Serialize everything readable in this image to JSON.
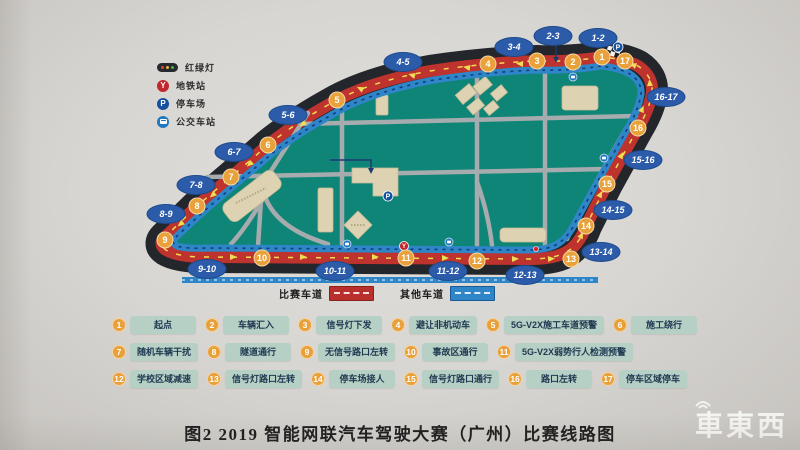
{
  "map_legend": {
    "items": [
      {
        "icon": "traffic-light-icon",
        "label": "红绿灯"
      },
      {
        "icon": "metro-icon",
        "label": "地铁站"
      },
      {
        "icon": "parking-icon",
        "label": "停车场"
      },
      {
        "icon": "bus-icon",
        "label": "公交车站"
      }
    ]
  },
  "lane_legend": {
    "race": {
      "label": "比赛车道",
      "color": "#b92f2b"
    },
    "other": {
      "label": "其他车道",
      "color": "#2e86c8"
    }
  },
  "route": {
    "waypoints": [
      {
        "n": "1",
        "x": 602,
        "y": 57
      },
      {
        "n": "2",
        "x": 573,
        "y": 62
      },
      {
        "n": "3",
        "x": 537,
        "y": 61
      },
      {
        "n": "4",
        "x": 488,
        "y": 64
      },
      {
        "n": "5",
        "x": 337,
        "y": 100
      },
      {
        "n": "6",
        "x": 268,
        "y": 145
      },
      {
        "n": "7",
        "x": 231,
        "y": 177
      },
      {
        "n": "8",
        "x": 197,
        "y": 206
      },
      {
        "n": "9",
        "x": 165,
        "y": 240
      },
      {
        "n": "10",
        "x": 262,
        "y": 258
      },
      {
        "n": "11",
        "x": 406,
        "y": 258
      },
      {
        "n": "12",
        "x": 477,
        "y": 261
      },
      {
        "n": "13",
        "x": 571,
        "y": 259
      },
      {
        "n": "14",
        "x": 586,
        "y": 226
      },
      {
        "n": "15",
        "x": 607,
        "y": 184
      },
      {
        "n": "16",
        "x": 638,
        "y": 128
      },
      {
        "n": "17",
        "x": 625,
        "y": 61
      }
    ],
    "segments": [
      {
        "label": "1-2",
        "x": 598,
        "y": 38
      },
      {
        "label": "2-3",
        "x": 553,
        "y": 36
      },
      {
        "label": "3-4",
        "x": 514,
        "y": 47
      },
      {
        "label": "4-5",
        "x": 403,
        "y": 62
      },
      {
        "label": "5-6",
        "x": 288,
        "y": 115
      },
      {
        "label": "6-7",
        "x": 234,
        "y": 152
      },
      {
        "label": "7-8",
        "x": 196,
        "y": 185
      },
      {
        "label": "8-9",
        "x": 166,
        "y": 214
      },
      {
        "label": "9-10",
        "x": 207,
        "y": 269
      },
      {
        "label": "10-11",
        "x": 335,
        "y": 271
      },
      {
        "label": "11-12",
        "x": 448,
        "y": 271
      },
      {
        "label": "12-13",
        "x": 525,
        "y": 275
      },
      {
        "label": "13-14",
        "x": 601,
        "y": 252
      },
      {
        "label": "14-15",
        "x": 613,
        "y": 210
      },
      {
        "label": "15-16",
        "x": 643,
        "y": 160
      },
      {
        "label": "16-17",
        "x": 666,
        "y": 97
      }
    ],
    "icons": [
      {
        "type": "parking",
        "x": 618,
        "y": 47
      },
      {
        "type": "parking",
        "x": 388,
        "y": 196
      },
      {
        "type": "metro",
        "x": 404,
        "y": 246
      },
      {
        "type": "bus",
        "x": 573,
        "y": 77
      },
      {
        "type": "bus",
        "x": 449,
        "y": 242
      },
      {
        "type": "bus",
        "x": 347,
        "y": 244
      },
      {
        "type": "bus",
        "x": 604,
        "y": 158
      },
      {
        "type": "light",
        "x": 536,
        "y": 249
      }
    ]
  },
  "checkpoints": {
    "rows": [
      [
        {
          "num": "1",
          "label": "起点"
        },
        {
          "num": "2",
          "label": "车辆汇入"
        },
        {
          "num": "3",
          "label": "信号灯下发"
        },
        {
          "num": "4",
          "label": "避让非机动车"
        },
        {
          "num": "5",
          "label": "5G-V2X施工车道预警"
        },
        {
          "num": "6",
          "label": "施工绕行"
        }
      ],
      [
        {
          "num": "7",
          "label": "随机车辆干扰"
        },
        {
          "num": "8",
          "label": "隧道通行"
        },
        {
          "num": "9",
          "label": "无信号路口左转"
        },
        {
          "num": "10",
          "label": "事故区通行"
        },
        {
          "num": "11",
          "label": "5G-V2X弱势行人检测预警"
        }
      ],
      [
        {
          "num": "12",
          "label": "学校区域减速"
        },
        {
          "num": "13",
          "label": "信号灯路口左转"
        },
        {
          "num": "14",
          "label": "停车场接人"
        },
        {
          "num": "15",
          "label": "信号灯路口通行"
        },
        {
          "num": "16",
          "label": "路口左转"
        },
        {
          "num": "17",
          "label": "停车区域停车"
        }
      ]
    ]
  },
  "caption": "图2 2019 智能网联汽车驾驶大赛（广州）比赛线路图",
  "watermark": "車東西",
  "colors": {
    "race_lane": "#bf332e",
    "other_lane": "#2e86c8",
    "track": "#23262b",
    "ground": "#0f8577",
    "waypoint": "#e9a23b",
    "segment_badge": "#2c5ca9",
    "arrow": "#f0dc55"
  }
}
